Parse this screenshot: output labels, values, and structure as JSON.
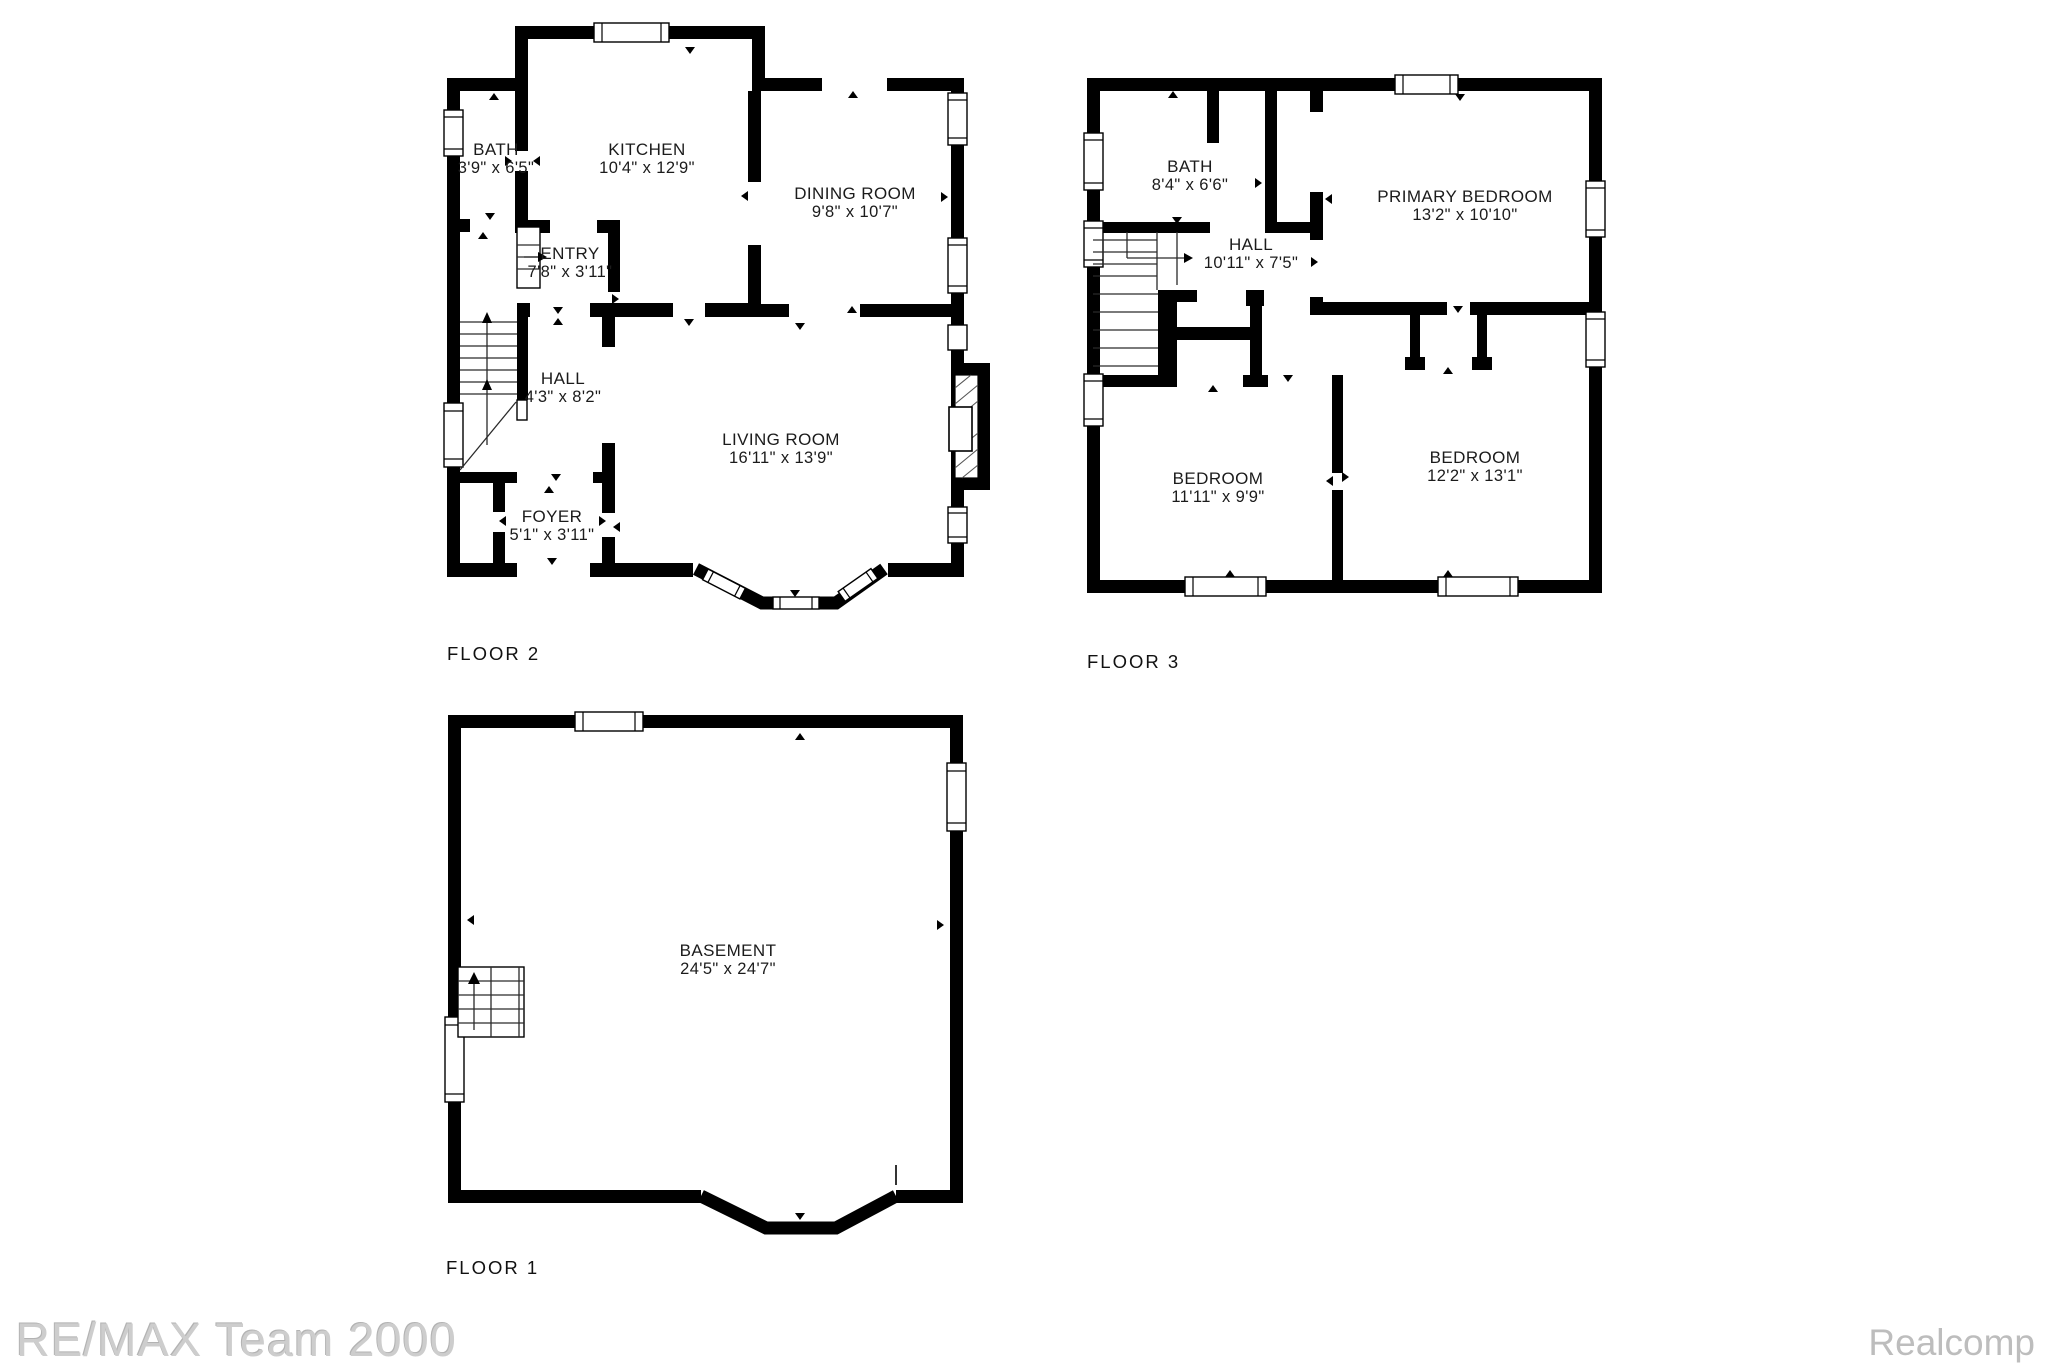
{
  "document_type": "floor-plan",
  "floors": {
    "floor2": {
      "label": "FLOOR 2",
      "rooms": {
        "bath": {
          "name": "BATH",
          "dims": "3'9\" x 6'5\""
        },
        "kitchen": {
          "name": "KITCHEN",
          "dims": "10'4\" x 12'9\""
        },
        "dining": {
          "name": "DINING ROOM",
          "dims": "9'8\" x 10'7\""
        },
        "entry": {
          "name": "ENTRY",
          "dims": "7'8\" x 3'11\""
        },
        "hall": {
          "name": "HALL",
          "dims": "4'3\" x 8'2\""
        },
        "living": {
          "name": "LIVING ROOM",
          "dims": "16'11\" x 13'9\""
        },
        "foyer": {
          "name": "FOYER",
          "dims": "5'1\" x 3'11\""
        }
      }
    },
    "floor3": {
      "label": "FLOOR 3",
      "rooms": {
        "bath": {
          "name": "BATH",
          "dims": "8'4\" x 6'6\""
        },
        "hall": {
          "name": "HALL",
          "dims": "10'11\" x 7'5\""
        },
        "primary": {
          "name": "PRIMARY BEDROOM",
          "dims": "13'2\" x 10'10\""
        },
        "bedroom1": {
          "name": "BEDROOM",
          "dims": "11'11\" x 9'9\""
        },
        "bedroom2": {
          "name": "BEDROOM",
          "dims": "12'2\" x 13'1\""
        }
      }
    },
    "floor1": {
      "label": "FLOOR 1",
      "rooms": {
        "basement": {
          "name": "BASEMENT",
          "dims": "24'5\" x 24'7\""
        }
      }
    }
  },
  "watermarks": {
    "left": "RE/MAX Team 2000",
    "right": "Realcomp"
  },
  "colors": {
    "wall": "#000000",
    "background": "#ffffff",
    "watermark_left": "#cdcdcd",
    "watermark_right": "#bdbdbd"
  }
}
